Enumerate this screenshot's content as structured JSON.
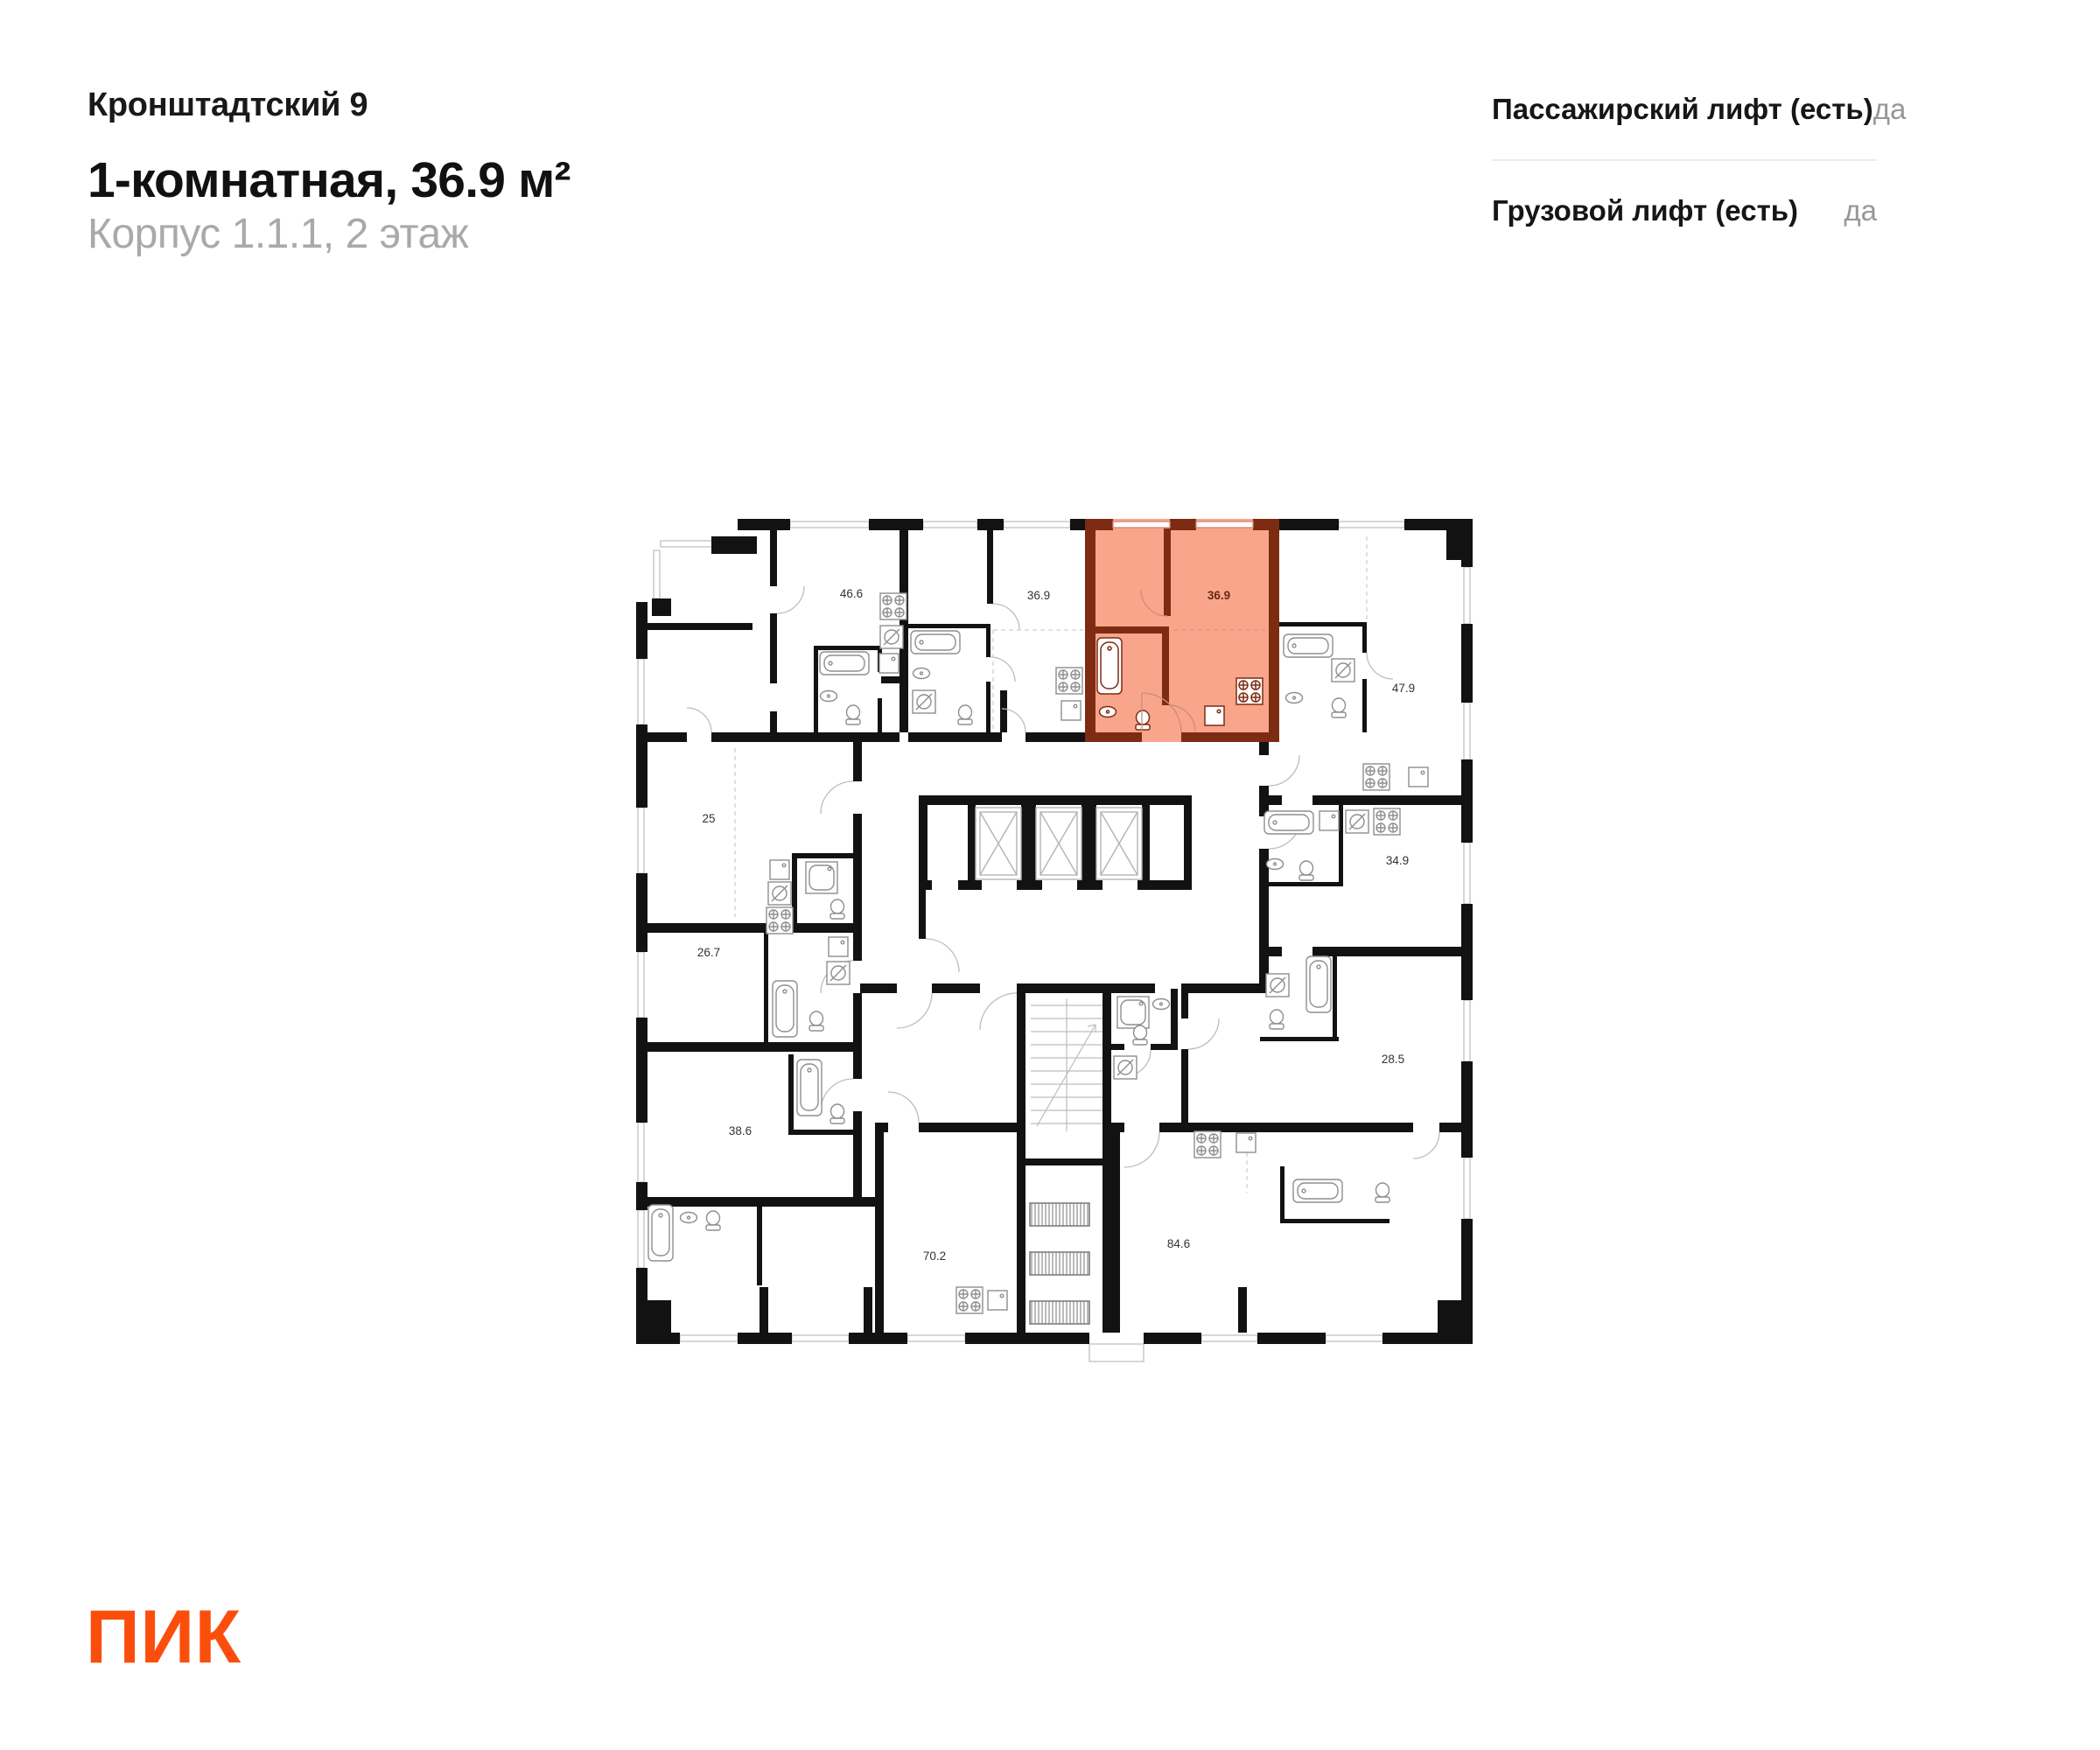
{
  "header": {
    "project_title": "Кронштадтский 9",
    "apartment_title": "1-комнатная, 36.9 м²",
    "subtitle": "Корпус 1.1.1, 2 этаж"
  },
  "info_panel": {
    "rows": [
      {
        "label": "Пассажирский лифт (есть)",
        "value": "да"
      },
      {
        "label": "Грузовой лифт (есть)",
        "value": "да"
      }
    ]
  },
  "floorplan": {
    "highlight": {
      "area_label": "36.9",
      "fill": "#F9A58C",
      "wall_color": "#7D2B13",
      "label_color": "#6B2712"
    },
    "area_labels": [
      {
        "label": "46.6"
      },
      {
        "label": "36.9"
      },
      {
        "label": "36.9",
        "highlighted": true
      },
      {
        "label": "47.9"
      },
      {
        "label": "25"
      },
      {
        "label": "34.9"
      },
      {
        "label": "26.7"
      },
      {
        "label": "28.5"
      },
      {
        "label": "38.6"
      },
      {
        "label": "70.2"
      },
      {
        "label": "84.6"
      }
    ]
  },
  "logo": {
    "text": "ПИК",
    "color": "#FB4E0D"
  }
}
